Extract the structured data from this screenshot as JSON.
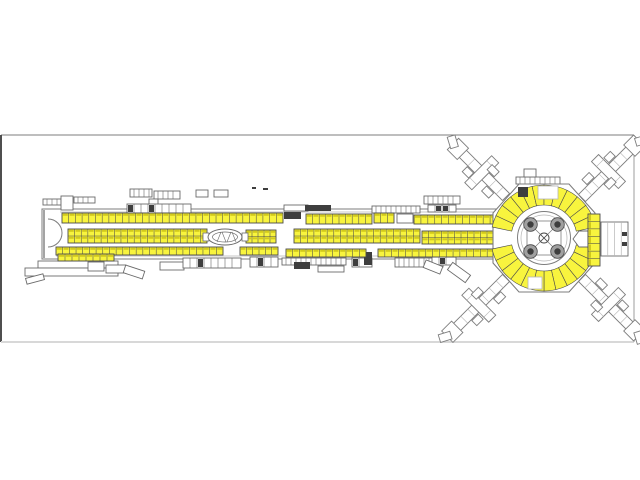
{
  "canvas": {
    "width": 640,
    "height": 480,
    "background": "#ffffff"
  },
  "frame": {
    "x": 1,
    "y": 135,
    "w": 633,
    "h": 207,
    "stroke_top": "#7e7e7e",
    "stroke_left": "#4f4f4f",
    "stroke_right": "#9c9c9c",
    "stroke_bottom": "#d8d8d8"
  },
  "palette": {
    "booth_fill": "#f8f43e",
    "booth_edge": "#4a4a4a",
    "booth_tick": "#b3a800",
    "line_dark": "#4a4a4a",
    "line_mid": "#7d7d7d",
    "line_light": "#b5b5b5",
    "structure": "#6a6a6a",
    "dark_fill": "#3e3e3e",
    "white": "#ffffff"
  },
  "concourse": {
    "x": 42,
    "y": 209,
    "w": 456,
    "h": 50,
    "inner_top_y": 212,
    "inner_bot_y": 256,
    "arc": {
      "x": 48,
      "y1": 219,
      "y2": 247,
      "r": 14
    }
  },
  "booth_rows": [
    {
      "name": "stands-top-west",
      "x": 62,
      "y": 213,
      "w": 221,
      "h": 10,
      "cells": 33
    },
    {
      "name": "stands-top-mid",
      "x": 306,
      "y": 214,
      "w": 66,
      "h": 10,
      "cells": 10
    },
    {
      "name": "stands-top-cluster",
      "x": 374,
      "y": 213,
      "w": 20,
      "h": 10,
      "cells": 3
    },
    {
      "name": "stands-top-east",
      "x": 414,
      "y": 215,
      "w": 83,
      "h": 9,
      "cells": 12
    },
    {
      "name": "stands-mid-west",
      "x": 68,
      "y": 229,
      "w": 139,
      "h": 14,
      "cells": 21,
      "double": true
    },
    {
      "name": "stands-mid-center1",
      "x": 246,
      "y": 230,
      "w": 30,
      "h": 13,
      "cells": 5,
      "double": true
    },
    {
      "name": "stands-mid-center2",
      "x": 294,
      "y": 229,
      "w": 126,
      "h": 14,
      "cells": 19,
      "double": true
    },
    {
      "name": "stands-mid-east",
      "x": 422,
      "y": 231,
      "w": 78,
      "h": 13,
      "cells": 12,
      "double": true,
      "bullet": true
    },
    {
      "name": "stands-bot-west",
      "x": 56,
      "y": 247,
      "w": 167,
      "h": 8,
      "cells": 25
    },
    {
      "name": "stands-bot-center1",
      "x": 240,
      "y": 247,
      "w": 38,
      "h": 8,
      "cells": 6
    },
    {
      "name": "stands-bot-center2",
      "x": 286,
      "y": 249,
      "w": 80,
      "h": 8,
      "cells": 12
    },
    {
      "name": "stands-bot-east",
      "x": 378,
      "y": 249,
      "w": 116,
      "h": 8,
      "cells": 17
    },
    {
      "name": "stands-lower-west",
      "x": 58,
      "y": 254,
      "w": 56,
      "h": 7,
      "cells": 8
    }
  ],
  "oval": {
    "cx": 225,
    "cy": 237,
    "rx": 17,
    "ry": 8,
    "rx2": 12.5,
    "ry2": 5,
    "end_left": {
      "x": 203,
      "y": 233,
      "w": 6,
      "h": 8
    },
    "end_right": {
      "x": 242,
      "y": 233,
      "w": 6,
      "h": 8
    }
  },
  "hub": {
    "cx": 544,
    "cy": 238,
    "octagon": [
      [
        493,
        213
      ],
      [
        519,
        184
      ],
      [
        569,
        184
      ],
      [
        595,
        213
      ],
      [
        595,
        263
      ],
      [
        569,
        292
      ],
      [
        519,
        292
      ],
      [
        493,
        263
      ]
    ],
    "ring": {
      "r_in": 33,
      "r_out": 53,
      "step_deg": 13,
      "bands": [
        [
          12,
          168
        ],
        [
          192,
          348
        ]
      ]
    },
    "extras": [
      {
        "t": "box",
        "x": 538,
        "y": 186,
        "w": 20,
        "h": 13
      },
      {
        "t": "dark",
        "x": 518,
        "y": 187,
        "w": 10,
        "h": 10
      },
      {
        "t": "box",
        "x": 528,
        "y": 277,
        "w": 14,
        "h": 12
      }
    ],
    "core": {
      "r_outer": 26.5,
      "r_inner": 23,
      "square_half": 17,
      "col_offset": 13.5,
      "col_r": 6.8,
      "col_core_r": 3.2,
      "center_r": 5
    }
  },
  "piers": [
    {
      "name": "pier-northwest",
      "x": 506,
      "y": 197,
      "angle": -135,
      "len": 66
    },
    {
      "name": "pier-northeast",
      "x": 582,
      "y": 198,
      "angle": -45,
      "len": 72
    },
    {
      "name": "pier-southwest",
      "x": 506,
      "y": 278,
      "angle": 135,
      "len": 74
    },
    {
      "name": "pier-southeast",
      "x": 582,
      "y": 278,
      "angle": 45,
      "len": 72
    }
  ],
  "east_block": {
    "hexagon": "M573,239 L579,231 L588,231 L588,247 L579,247 Z",
    "column": {
      "x": 588,
      "y": 214,
      "w": 12,
      "h": 52,
      "cells": 7
    },
    "hall": {
      "x": 601,
      "y": 222,
      "w": 27,
      "h": 34,
      "lines": 3
    },
    "marks": [
      {
        "x": 622,
        "y": 232,
        "w": 5,
        "h": 4
      },
      {
        "x": 622,
        "y": 242,
        "w": 5,
        "h": 4
      }
    ]
  },
  "structures": [
    {
      "t": "comb",
      "x": 43,
      "y": 199,
      "w": 18,
      "h": 6
    },
    {
      "t": "box",
      "x": 61,
      "y": 196,
      "w": 12,
      "h": 14
    },
    {
      "t": "comb",
      "x": 74,
      "y": 197,
      "w": 21,
      "h": 6
    },
    {
      "t": "comb",
      "x": 130,
      "y": 189,
      "w": 22,
      "h": 8
    },
    {
      "t": "comb",
      "x": 154,
      "y": 191,
      "w": 26,
      "h": 8
    },
    {
      "t": "box",
      "x": 149,
      "y": 199,
      "w": 9,
      "h": 7
    },
    {
      "t": "cells",
      "x": 127,
      "y": 204,
      "w": 64,
      "h": 9,
      "dark": [
        0,
        3
      ]
    },
    {
      "t": "box",
      "x": 196,
      "y": 190,
      "w": 12,
      "h": 7
    },
    {
      "t": "box",
      "x": 214,
      "y": 190,
      "w": 14,
      "h": 7
    },
    {
      "t": "dark",
      "x": 252,
      "y": 187,
      "w": 4,
      "h": 2
    },
    {
      "t": "dark",
      "x": 263,
      "y": 188,
      "w": 5,
      "h": 2
    },
    {
      "t": "box",
      "x": 284,
      "y": 205,
      "w": 24,
      "h": 6
    },
    {
      "t": "dark",
      "x": 284,
      "y": 212,
      "w": 17,
      "h": 7
    },
    {
      "t": "dark",
      "x": 305,
      "y": 205,
      "w": 26,
      "h": 6
    },
    {
      "t": "comb",
      "x": 372,
      "y": 206,
      "w": 48,
      "h": 7
    },
    {
      "t": "box",
      "x": 397,
      "y": 214,
      "w": 16,
      "h": 9
    },
    {
      "t": "comb",
      "x": 424,
      "y": 196,
      "w": 36,
      "h": 8
    },
    {
      "t": "cells",
      "x": 428,
      "y": 205,
      "w": 28,
      "h": 7,
      "dark": [
        1,
        2
      ]
    },
    {
      "t": "comb",
      "x": 516,
      "y": 177,
      "w": 44,
      "h": 7
    },
    {
      "t": "box",
      "x": 524,
      "y": 169,
      "w": 12,
      "h": 8
    },
    {
      "t": "box",
      "x": 38,
      "y": 261,
      "w": 80,
      "h": 7
    },
    {
      "t": "box",
      "x": 25,
      "y": 268,
      "w": 93,
      "h": 8
    },
    {
      "t": "box",
      "x": 26,
      "y": 276,
      "w": 18,
      "h": 6,
      "rot": -15
    },
    {
      "t": "box",
      "x": 88,
      "y": 262,
      "w": 16,
      "h": 9
    },
    {
      "t": "box",
      "x": 106,
      "y": 265,
      "w": 20,
      "h": 8
    },
    {
      "t": "box",
      "x": 124,
      "y": 268,
      "w": 20,
      "h": 8,
      "rot": 18
    },
    {
      "t": "box",
      "x": 160,
      "y": 262,
      "w": 24,
      "h": 8
    },
    {
      "t": "cells",
      "x": 183,
      "y": 258,
      "w": 58,
      "h": 10,
      "dark": [
        2
      ]
    },
    {
      "t": "cells",
      "x": 250,
      "y": 257,
      "w": 28,
      "h": 10,
      "dark": [
        1
      ]
    },
    {
      "t": "comb",
      "x": 282,
      "y": 258,
      "w": 64,
      "h": 7
    },
    {
      "t": "dark",
      "x": 294,
      "y": 262,
      "w": 16,
      "h": 7
    },
    {
      "t": "box",
      "x": 318,
      "y": 266,
      "w": 26,
      "h": 6
    },
    {
      "t": "cells",
      "x": 352,
      "y": 258,
      "w": 20,
      "h": 9,
      "dark": [
        0
      ]
    },
    {
      "t": "dark",
      "x": 364,
      "y": 252,
      "w": 8,
      "h": 13
    },
    {
      "t": "comb",
      "x": 395,
      "y": 258,
      "w": 48,
      "h": 9
    },
    {
      "t": "cells",
      "x": 432,
      "y": 257,
      "w": 24,
      "h": 8,
      "dark": [
        1
      ]
    },
    {
      "t": "box",
      "x": 424,
      "y": 263,
      "w": 18,
      "h": 8,
      "rot": 22
    },
    {
      "t": "box",
      "x": 448,
      "y": 268,
      "w": 22,
      "h": 9,
      "rot": 36
    }
  ]
}
